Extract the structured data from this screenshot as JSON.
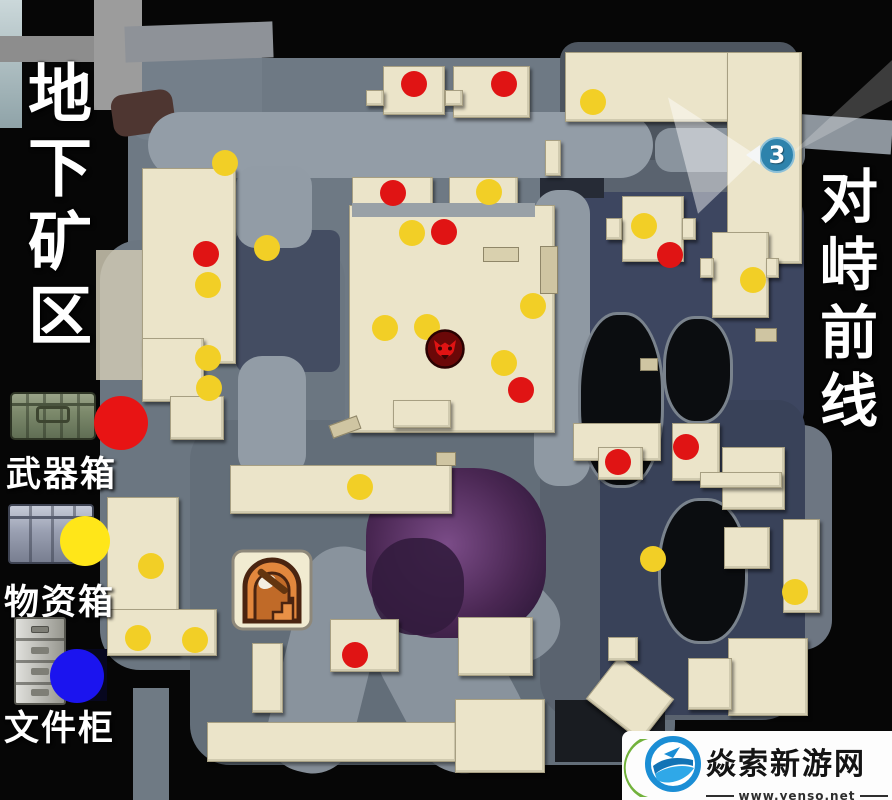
{
  "titles": {
    "left_vertical": "地下矿区",
    "right_vertical": "对峙前线"
  },
  "legend": {
    "items": [
      {
        "id": "weapon-box",
        "label": "武器箱",
        "dot_color": "#e81414",
        "icon": "military-crate"
      },
      {
        "id": "supply-box",
        "label": "物资箱",
        "dot_color": "#ffe619",
        "icon": "metal-crate"
      },
      {
        "id": "file-cabinet",
        "label": "文件柜",
        "dot_color": "#1b14ef",
        "icon": "file-cabinet"
      }
    ]
  },
  "map_markers": {
    "dot_diameter_px": 26,
    "map_dot_colors": {
      "weapon_box": "#e01414",
      "supply_box": "#f2cf26"
    },
    "weapon_boxes": [
      [
        414,
        84
      ],
      [
        504,
        84
      ],
      [
        393,
        193
      ],
      [
        444,
        232
      ],
      [
        206,
        254
      ],
      [
        670,
        255
      ],
      [
        521,
        390
      ],
      [
        686,
        447
      ],
      [
        618,
        462
      ],
      [
        355,
        655
      ]
    ],
    "supply_boxes": [
      [
        593,
        102
      ],
      [
        225,
        163
      ],
      [
        489,
        192
      ],
      [
        644,
        226
      ],
      [
        412,
        233
      ],
      [
        267,
        248
      ],
      [
        753,
        280
      ],
      [
        208,
        285
      ],
      [
        533,
        306
      ],
      [
        427,
        327
      ],
      [
        385,
        328
      ],
      [
        208,
        358
      ],
      [
        504,
        363
      ],
      [
        209,
        388
      ],
      [
        360,
        487
      ],
      [
        653,
        559
      ],
      [
        151,
        566
      ],
      [
        795,
        592
      ],
      [
        138,
        638
      ],
      [
        195,
        640
      ]
    ],
    "boss_marker": {
      "x": 445,
      "y": 349
    },
    "waypoint": {
      "number": "3",
      "x": 777,
      "y": 155
    },
    "mine_entrance_icon": {
      "x": 272,
      "y": 592
    }
  },
  "watermark": {
    "site_name": "焱索新游网",
    "site_url": "www.yenso.net"
  }
}
